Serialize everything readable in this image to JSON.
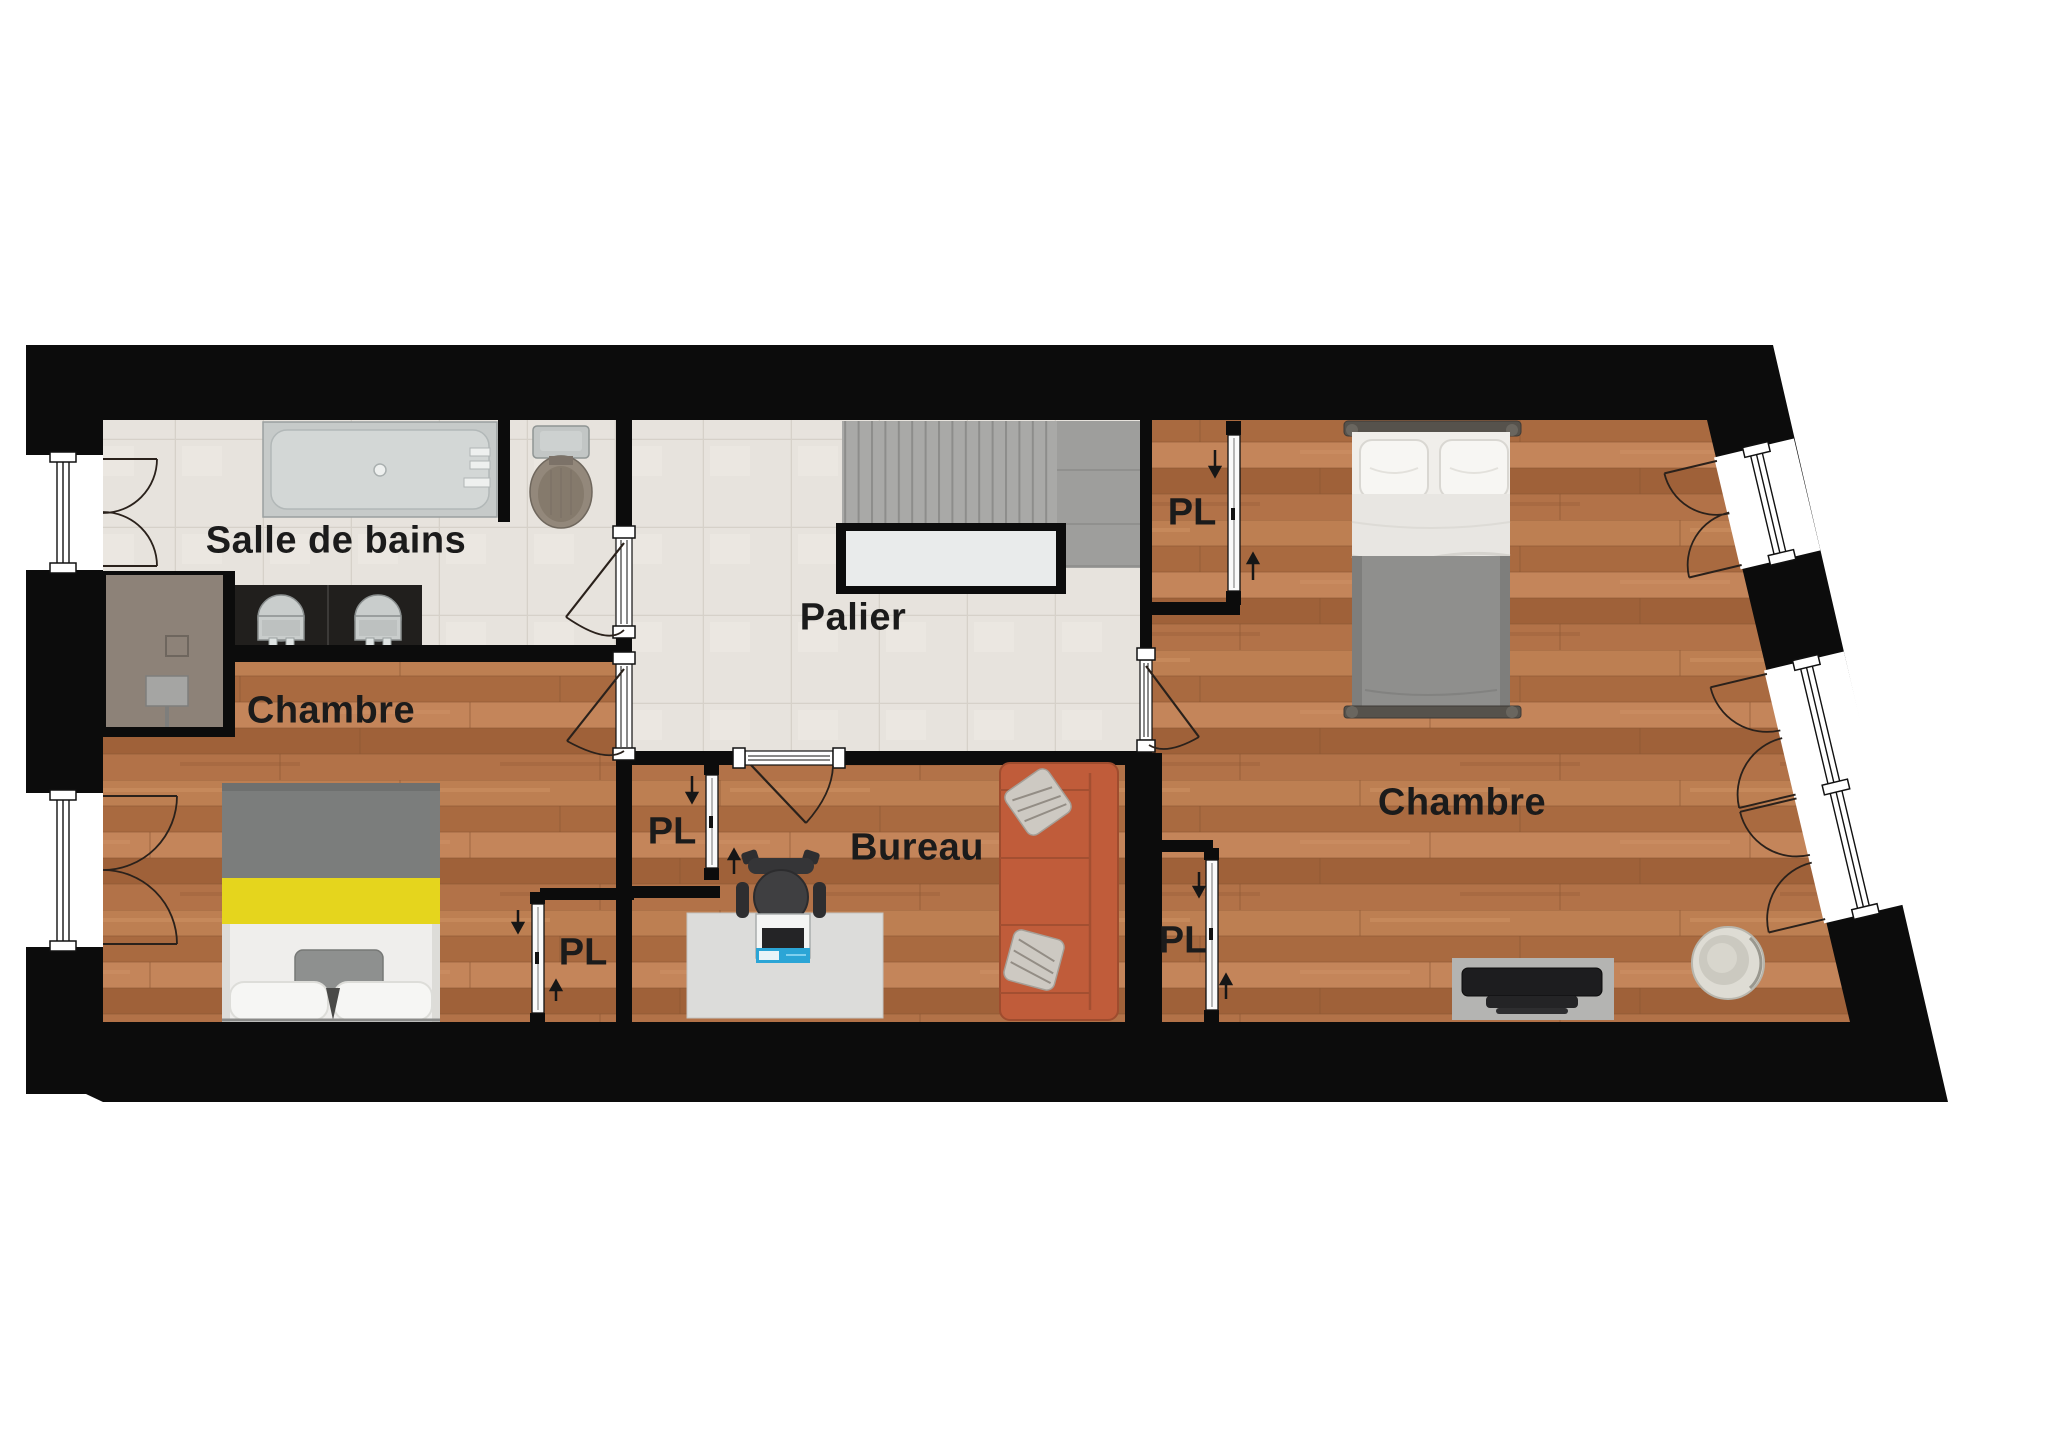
{
  "plan": {
    "type": "floor-plan-etage",
    "rooms": [
      {
        "id": "salle-de-bains",
        "label": "Salle de bains"
      },
      {
        "id": "palier",
        "label": "Palier"
      },
      {
        "id": "chambre-ouest",
        "label": "Chambre"
      },
      {
        "id": "bureau",
        "label": "Bureau"
      },
      {
        "id": "chambre-est",
        "label": "Chambre"
      }
    ],
    "closets": [
      {
        "id": "pl-chambre-est-haut",
        "label": "PL"
      },
      {
        "id": "pl-bureau",
        "label": "PL"
      },
      {
        "id": "pl-chambre-ouest",
        "label": "PL"
      },
      {
        "id": "pl-chambre-est-bas",
        "label": "PL"
      }
    ],
    "colors": {
      "wall": "#0c0c0c",
      "wood_floor": "#b5774b",
      "tile_floor": "#e7e3dd",
      "stairs": "#a9a9a7",
      "sofa": "#c05c3a",
      "bed_accent_yellow": "#e5d51d",
      "shower": "#8d8278"
    },
    "furniture": [
      "bathtub",
      "toilet",
      "washbasin",
      "washbasin",
      "shower",
      "staircase",
      "stairwell-void",
      "double-bed",
      "double-bed",
      "desk",
      "office-chair",
      "laptop",
      "sofa",
      "cushion",
      "cushion",
      "tv-unit",
      "egg-chair"
    ]
  }
}
